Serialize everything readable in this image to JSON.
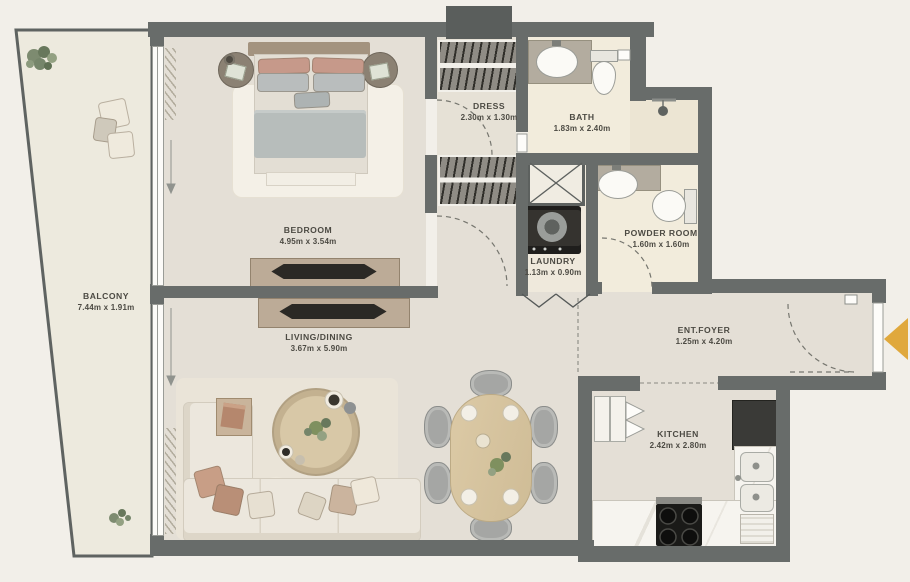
{
  "rooms": {
    "balcony": {
      "name": "BALCONY",
      "dims": "7.44m x 1.91m"
    },
    "bedroom": {
      "name": "BEDROOM",
      "dims": "4.95m x 3.54m"
    },
    "dress": {
      "name": "DRESS",
      "dims": "2.30m x 1.30m"
    },
    "bath": {
      "name": "BATH",
      "dims": "1.83m x 2.40m"
    },
    "laundry": {
      "name": "LAUNDRY",
      "dims": "1.13m x 0.90m"
    },
    "powder_room": {
      "name": "POWDER ROOM",
      "dims": "1.60m x 1.60m"
    },
    "living_dining": {
      "name": "LIVING/DINING",
      "dims": "3.67m x 5.90m"
    },
    "ent_foyer": {
      "name": "ENT.FOYER",
      "dims": "1.25m x 4.20m"
    },
    "kitchen": {
      "name": "KITCHEN",
      "dims": "2.42m x 2.80m"
    }
  },
  "colors": {
    "background": "#f2efe9",
    "wall": "#686c6a",
    "floor": "#e4dfd6",
    "wet_floor": "#f2ecdc",
    "balcony_floor": "#edeade",
    "entry_arrow": "#e0a83c",
    "label_text": "#4c4a43"
  }
}
